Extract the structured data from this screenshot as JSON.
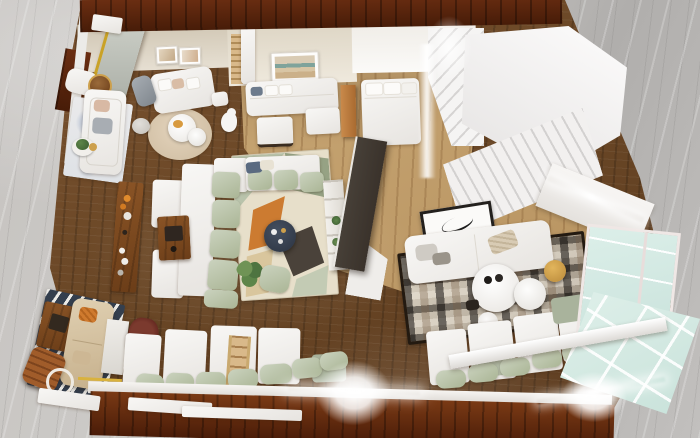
{
  "scene": {
    "description": "Photorealistic top-down 3D dollhouse render of a furnished open-plan apartment with warm wood floors, surrounded by gray marble flooring; a white staircase at top right, glass partition wall at right, long cushioned window bench along the bottom wall and bright lens flares from interior lighting",
    "view": "top-down 3D render, no visible text",
    "rooms": [
      {
        "name": "reading-lounge",
        "label": "Top-left lounge: white sofa on blue abstract rug, loveseat, round nesting tables on beige round rug, desk chair, dog figurine"
      },
      {
        "name": "guest-room",
        "label": "Top-center room: landscape artwork, white L-sofa, white ottoman, oak wardrobe, white bed with pillows"
      },
      {
        "name": "living-room",
        "label": "Central living room: modular sectional with sage cushions, geometric rug, round navy coffee table, plant, pouf, walnut media console and coffee table, dark TV partition with white shelf column"
      },
      {
        "name": "family-room",
        "label": "Right room: white sofa, black-and-white patchwork rug, white round nesting coffee tables, brass stool, leaning framed sketch"
      },
      {
        "name": "den",
        "label": "Bottom-left den: tan sofa on navy striped rug, walnut square table, leather folding chair, oxblood armchair, marble console"
      },
      {
        "name": "window-bench",
        "label": "Bottom wall: long bench with white seat backs and sage green pillows, wooden ladder"
      },
      {
        "name": "staircase",
        "label": "Top-right white staircase with landing"
      },
      {
        "name": "glazing",
        "label": "Right side glass partition and glazed corner with LED light strips"
      }
    ],
    "objects": [
      "marble-floor",
      "wood-floor",
      "oak-floor",
      "mahogany-wall-band",
      "blue-abstract-rug",
      "round-beige-rug",
      "geometric-rug",
      "patchwork-rug",
      "striped-rug",
      "sectional-sofa",
      "white-sofa",
      "tan-sofa",
      "loveseat",
      "daybed",
      "bed",
      "navy-coffee-table",
      "walnut-coffee-table",
      "media-console",
      "nesting-tables",
      "gold-stool",
      "oxblood-chair",
      "leather-folding-chair",
      "desk-chair",
      "plant",
      "pouf",
      "dog-figurine",
      "wall-art",
      "landscape-art",
      "leaning-art",
      "staircase",
      "glass-wall",
      "glass-skylight",
      "led-strip",
      "lens-flare",
      "window-bench-cushions",
      "wooden-ladder",
      "marble-console",
      "oak-wardrobe",
      "shelf-column",
      "tv-partition"
    ],
    "palette": {
      "marble-a": "#c6c3c0",
      "marble-b": "#b0aeac",
      "wall-wood-a": "#6b2e12",
      "wall-wood-b": "#471c08",
      "floor-a": "#7b5330",
      "floor-b": "#5b3a1e",
      "oak-a": "#cfae7c",
      "oak-b": "#b08b58",
      "white-furniture": "#f2f0ec",
      "sage": "#aab595",
      "walnut": "#8a5426",
      "rug-cream": "#e7dfca",
      "rug-orange": "#cc7b31",
      "rug-olive": "#96a284",
      "rug-charcoal": "#4a423a",
      "rug-navy": "#343f4e",
      "glass": "#dcefe9",
      "tv-dark": "#3a322b",
      "gold": "#cda04c",
      "oxblood": "#5c211b",
      "leather": "#a05c2a",
      "glow": "#ffffff"
    }
  }
}
